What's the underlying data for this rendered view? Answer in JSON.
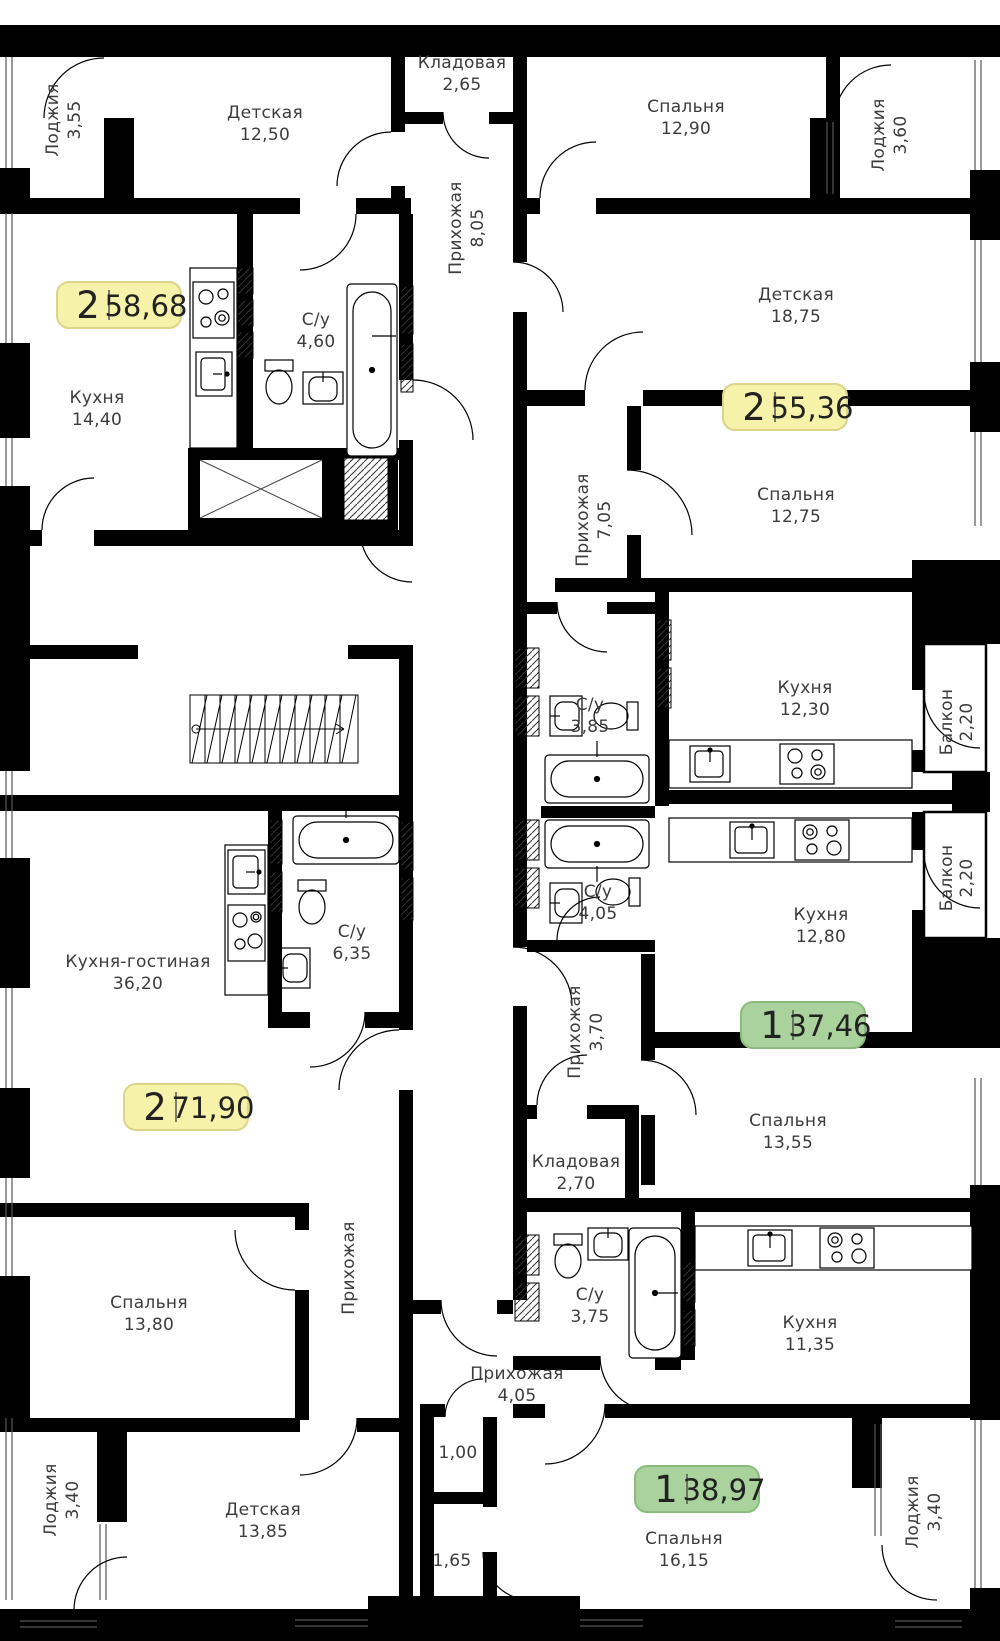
{
  "title": "Floor plan with apartments",
  "colors": {
    "wall": "#000000",
    "text": "#3c3c3c",
    "badge_yellow": "#f6f2a9",
    "badge_yellow_border": "#ddd48b",
    "badge_green": "#a9d29c",
    "badge_green_border": "#8bbc7e"
  },
  "badges": [
    {
      "rooms": "2",
      "area": "58,68",
      "fill": "#f6f2a9"
    },
    {
      "rooms": "2",
      "area": "55,36",
      "fill": "#f6f2a9"
    },
    {
      "rooms": "2",
      "area": "71,90",
      "fill": "#f6f2a9"
    },
    {
      "rooms": "1",
      "area": "37,46",
      "fill": "#a9d29c"
    },
    {
      "rooms": "1",
      "area": "38,97",
      "fill": "#a9d29c"
    }
  ],
  "rooms": [
    {
      "label": "Лоджия",
      "area": "3,55"
    },
    {
      "label": "Детская",
      "area": "12,50"
    },
    {
      "label": "Кладовая",
      "area": "2,65"
    },
    {
      "label": "Спальня",
      "area": "12,90"
    },
    {
      "label": "Лоджия",
      "area": "3,60"
    },
    {
      "label": "Прихожая",
      "area": "8,05"
    },
    {
      "label": "Кухня",
      "area": "14,40"
    },
    {
      "label": "С/у",
      "area": "4,60"
    },
    {
      "label": "Детская",
      "area": "18,75"
    },
    {
      "label": "Спальня",
      "area": "12,75"
    },
    {
      "label": "Прихожая",
      "area": "7,05"
    },
    {
      "label": "С/у",
      "area": "3,85"
    },
    {
      "label": "Кухня",
      "area": "12,30"
    },
    {
      "label": "Балкон",
      "area": "2,20"
    },
    {
      "label": "Кухня-гостиная",
      "area": "36,20"
    },
    {
      "label": "С/у",
      "area": "6,35"
    },
    {
      "label": "С/у",
      "area": "4,05"
    },
    {
      "label": "Кухня",
      "area": "12,80"
    },
    {
      "label": "Балкон",
      "area": "2,20"
    },
    {
      "label": "Прихожая",
      "area": "3,70"
    },
    {
      "label": "Спальня",
      "area": "13,55"
    },
    {
      "label": "Кладовая",
      "area": "2,70"
    },
    {
      "label": "С/у",
      "area": "3,75"
    },
    {
      "label": "Кухня",
      "area": "11,35"
    },
    {
      "label": "Спальня",
      "area": "13,80"
    },
    {
      "label": "Прихожая",
      "area": ""
    },
    {
      "label": "Прихожая",
      "area": "4,05"
    },
    {
      "label": "Детская",
      "area": "13,85"
    },
    {
      "label": "Лоджия",
      "area": "3,40"
    },
    {
      "label": "Спальня",
      "area": "16,15"
    },
    {
      "label": "Лоджия",
      "area": "3,40"
    },
    {
      "label": "",
      "area": "1,00"
    },
    {
      "label": "",
      "area": "1,65"
    }
  ]
}
